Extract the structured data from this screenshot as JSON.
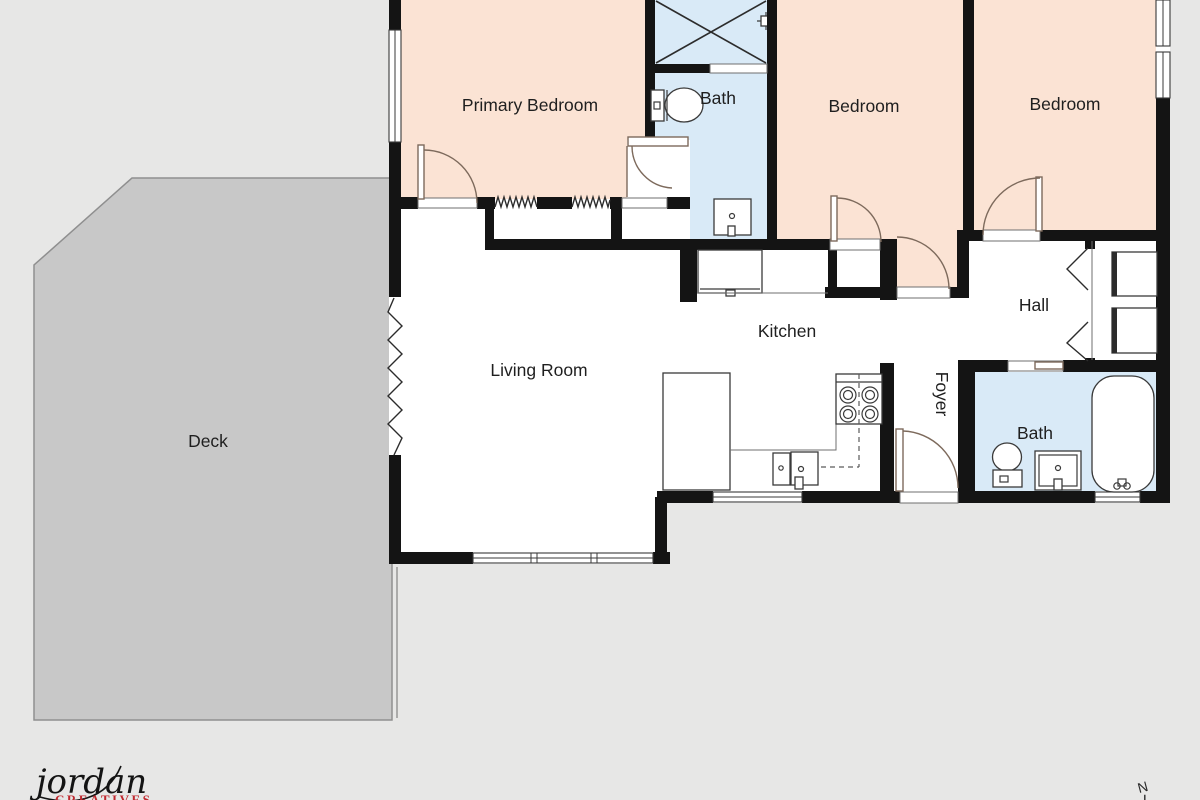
{
  "page": {
    "background": "#e7e7e6"
  },
  "colors": {
    "bedroom_fill": "#fbe3d4",
    "bath_fill": "#d9eaf7",
    "deck_fill": "#c8c8c8",
    "floor_fill": "#ffffff",
    "wall": "#141414",
    "logo_red": "#c0272d"
  },
  "rooms": {
    "primary_bedroom": {
      "label": "Primary Bedroom"
    },
    "bath_top": {
      "label": "Bath"
    },
    "bedroom_middle": {
      "label": "Bedroom"
    },
    "bedroom_right": {
      "label": "Bedroom"
    },
    "hall": {
      "label": "Hall"
    },
    "kitchen": {
      "label": "Kitchen"
    },
    "living_room": {
      "label": "Living Room"
    },
    "foyer": {
      "label": "Foyer"
    },
    "bath_bottom": {
      "label": "Bath"
    },
    "deck": {
      "label": "Deck"
    }
  },
  "branding": {
    "logo_name": "jordan",
    "logo_tagline": "CREATIVES"
  },
  "compass": {
    "north_label": "N"
  }
}
